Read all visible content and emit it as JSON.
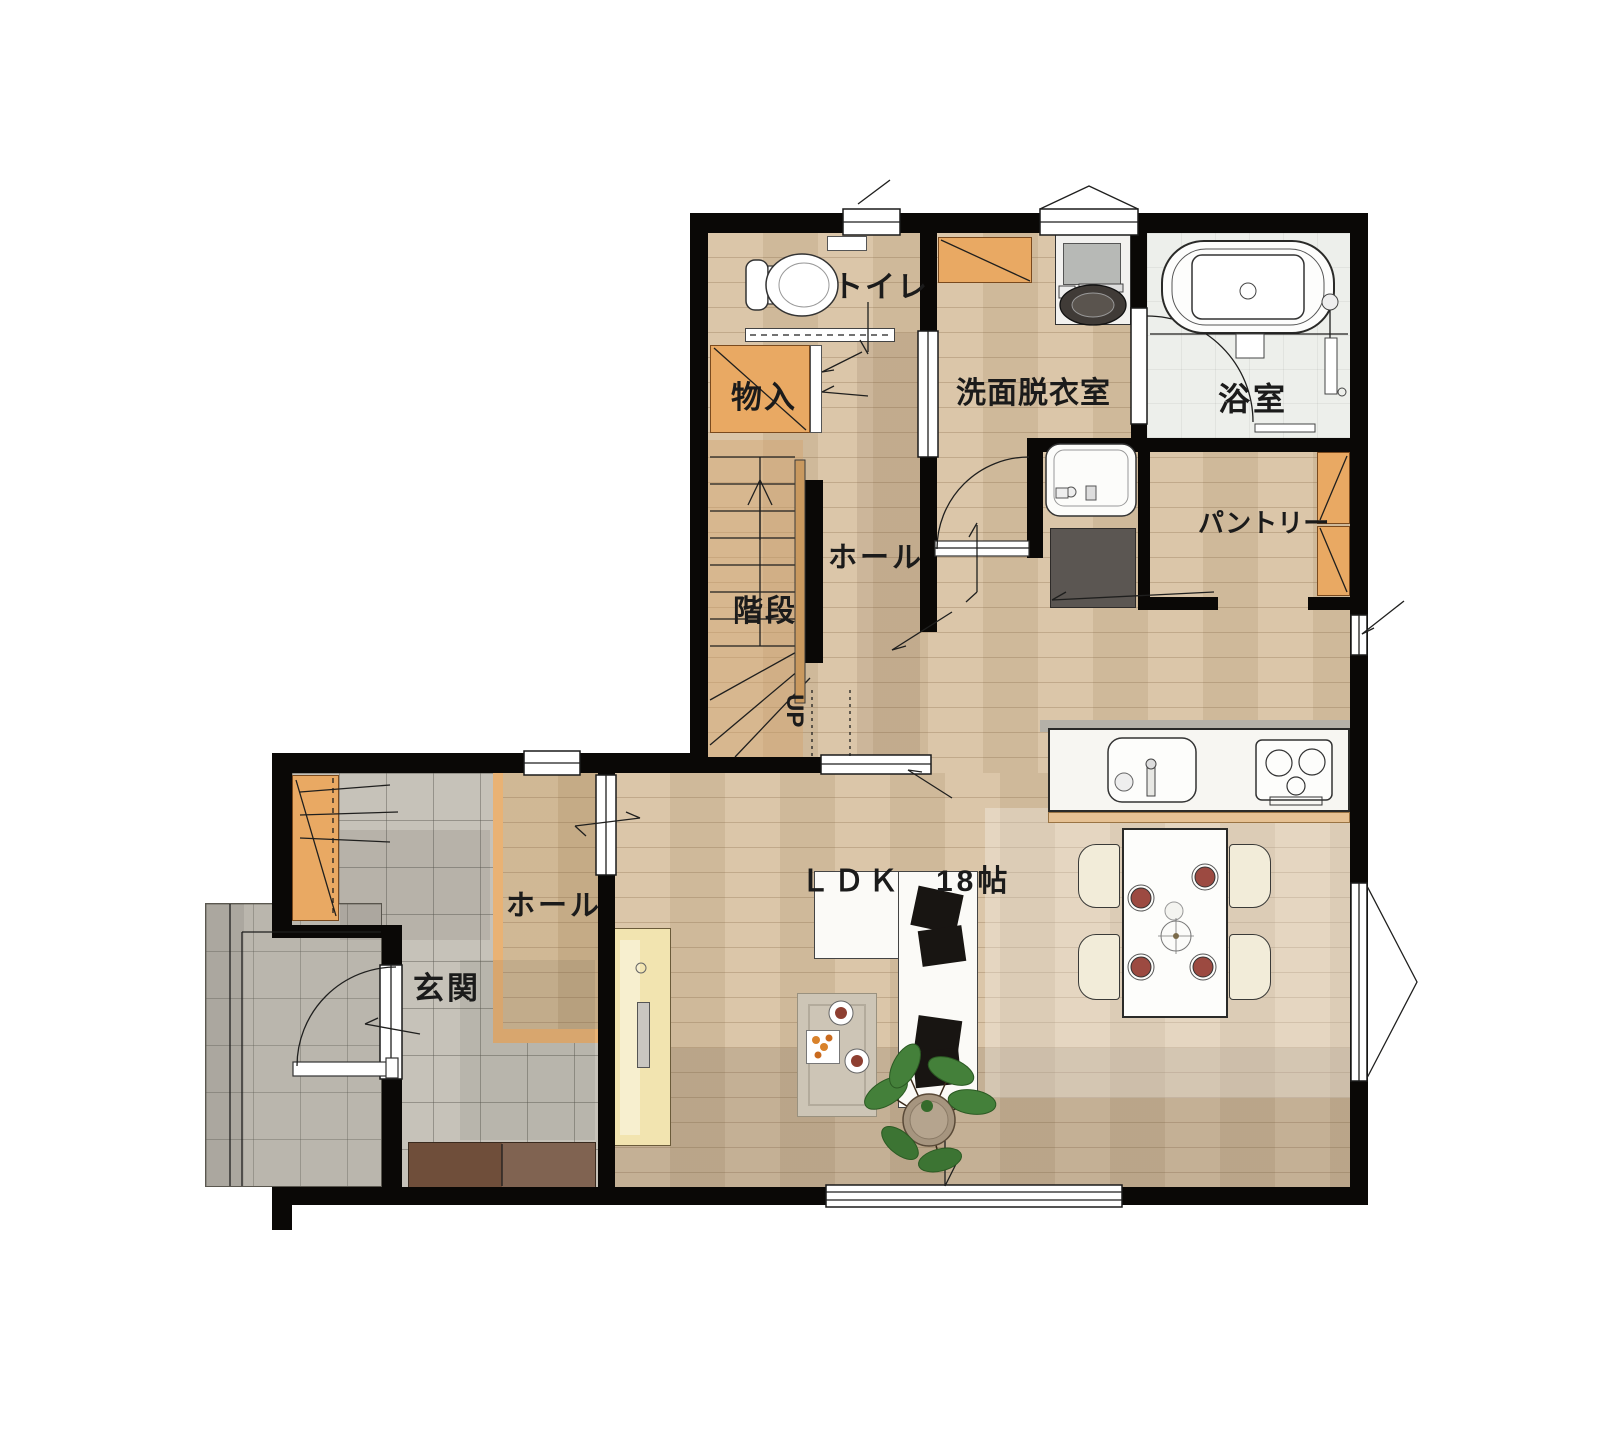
{
  "rooms": {
    "toilet": "トイレ",
    "storage": "物入",
    "washroom": "洗面脱衣室",
    "bathroom": "浴室",
    "pantry": "パントリー",
    "hall_upper": "ホール",
    "stairs": "階段",
    "stairs_up": "UP",
    "hall_lower": "ホール",
    "entrance": "玄関",
    "ldk": "ＬＤＫ　18帖"
  },
  "palette": {
    "wall": "#0a0806",
    "wood": "#d8c2a3",
    "tileE": "#c6c2b9",
    "tileP": "#bab6ad",
    "bathf": "#edefeb",
    "cab": "#e9a963",
    "step": "#e9b274",
    "counter": "#f7f6f2",
    "appliance": "#5b5652",
    "shoecab": "#6f4e3a",
    "tvboard": "#f2e4b0",
    "plate": "#9c4a41",
    "plant": "#44803a"
  }
}
